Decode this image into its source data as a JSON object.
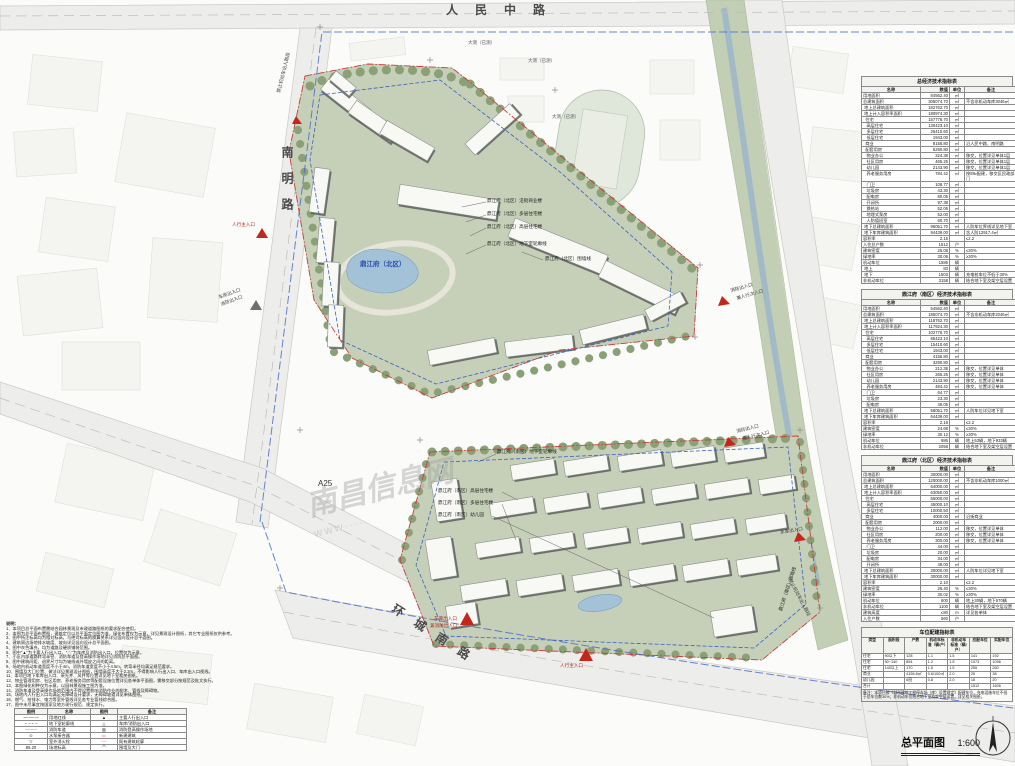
{
  "title_block": {
    "title": "总平面图",
    "scale": "1:600"
  },
  "roads": {
    "top": "人民中路",
    "left": "南明路",
    "bottom": "环城南路",
    "a25": "A25"
  },
  "survey_labels": {
    "s1": "大测（已测）",
    "s2": "大测（已测）",
    "s3": "大测（已测）"
  },
  "watermark": {
    "name": "南昌信息网",
    "www": "WWW····"
  },
  "project": {
    "north_center": "鼎江府（北区）"
  },
  "callouts": {
    "north": {
      "c1": "鼎江府（北区）沿街商业楼",
      "c2": "鼎江府（北区）多层住宅楼",
      "c3": "鼎江府（北区）高层住宅楼",
      "c4": "鼎江府（北区）地下室轮廓线",
      "c5": "鼎江府（北区）围墙线"
    },
    "south": {
      "s1": "鼎江府（南区）地下室轮廓线",
      "s2": "鼎江府（南区）高层住宅楼",
      "s3": "鼎江府（南区）多层住宅楼",
      "s4": "鼎江府（南区）幼儿园",
      "s5": "鼎江府（南区）围墙线"
    }
  },
  "entrances": {
    "left_main": "人行主入口",
    "left_garage": "车库出入口",
    "left_fire": "消防出入口",
    "right_fire_1": "消防出入口",
    "right_sub_1": "兼人行次入口",
    "right_fire_2": "消防出入口",
    "right_sub_2": "兼人行次入口",
    "right_garage": "车库出入口",
    "no_vehicle": "禁止机动车出入路段",
    "top_no_vehicle": "禁止机动车出入路段",
    "bottom_garage_1": "车库出入口",
    "bottom_garage_2": "兼消防出入口",
    "bottom_main": "人行主入口"
  },
  "notes": {
    "heading": "说明：",
    "items": [
      "1、本项目总平面布置需结合园林景观及市政道路图纸的要求配合使用。",
      "2、本图为总平面布置图，建筑定位以总平面定位图为准，绿化布置仅为示意，详见景观设计图纸，其它专业图纸仅供参考。",
      "3、图中所注标高均为相对标高，与绝对标高的换算关系详见竖向设计总平面图。",
      "4、建筑周边场地排水坡度、坡向详见竖向设计总平面图。",
      "5、图中灰色填充，均为道路及硬质铺装范围。",
      "6、图中\"▲\"为主要人行出入口，\"△\"为车库及消防出入口，位置仅为示意。",
      "7、小区内部道路转弯半径、消防车道及登高操作场地详见消防总平面图。",
      "8、图中建筑间距、退界尺寸均为轴线或外墙皮之间的距离。",
      "9、场地内机动车道宽度不小于4m，消防车道宽度不小于4.5m，转弯半径均满足规范要求。",
      "10、围墙及大门位置、做法详见景观设计图纸，围墙高度不大于2.2m，不得影响人行出入口、车库出入口视线。",
      "11、本项目地下车库出入口、采光井、风井等位置详见地下室相关图纸。",
      "12、物业管理用房、社区用房、养老服务用房等配套设施位置详见各单体平面图，需移交部分按规范及批文执行。",
      "13、本图绿化树种仅为示意，以园林景观施工图为准。",
      "14、消防车道及登高操作场地范围内不得设置影响消防作业的树木、管线及障碍物。",
      "15、场地内人行出入口均满足无障碍设计要求，无障碍坡道详见单体图纸。",
      "16、燃气、给排水、电力等室外管线详见各专业管线综合图。",
      "17、图中未尽事宜按国家及地方现行规范、规定执行。"
    ]
  },
  "legend": {
    "rows": [
      [
        "图例",
        "名称",
        "图例",
        "备注"
      ],
      [
        "—·—·—",
        "用地红线",
        "▲",
        "主要人行出入口"
      ],
      [
        "– – – –",
        "地下室轮廓线",
        "△",
        "车库/消防出入口"
      ],
      [
        "────",
        "消防车道",
        "▨",
        "消防登高操作场地"
      ],
      [
        "⊙",
        "水泵接合器",
        "▭",
        "新建建筑"
      ],
      [
        "▽",
        "室外消火栓",
        "┄┄",
        "既有建筑轮廓"
      ],
      [
        "85.20",
        "场地标高",
        "⌒",
        "围墙及大门"
      ]
    ]
  },
  "tables": {
    "overall": {
      "title": "总经济技术指标表",
      "rows": [
        [
          "名称",
          "数值",
          "单位",
          "备注"
        ],
        [
          "用地面积",
          "84562.40",
          "㎡",
          ""
        ],
        [
          "总建筑面积",
          "305074.70",
          "㎡",
          "不含非机动车库3046㎡"
        ],
        [
          " 地上总建筑面积",
          "182762.70",
          "㎡",
          ""
        ],
        [
          " 地上计入容积率面积",
          "180974.30",
          "㎡",
          ""
        ],
        [
          "  住宅",
          "157776.70",
          "㎡",
          ""
        ],
        [
          "   高层住宅",
          "130423.10",
          "㎡",
          ""
        ],
        [
          "   多层住宅",
          "25410.60",
          "㎡",
          ""
        ],
        [
          "   低层住宅",
          "1943.00",
          "㎡",
          ""
        ],
        [
          "  商业",
          "8156.80",
          "㎡",
          "沿人民中路、南明路"
        ],
        [
          "  配套用房",
          "5290.80",
          "㎡",
          ""
        ],
        [
          "   物业办公",
          "324.38",
          "㎡",
          "移交，位置详见单体1层"
        ],
        [
          "   社区用房",
          "465.25",
          "㎡",
          "移交，位置详见单体1层"
        ],
        [
          "   幼儿园",
          "2143.90",
          "㎡",
          "移交，位置详见单体1层"
        ],
        [
          "   养老服务用房",
          "784.42",
          "㎡",
          "按5‰配建，移交区民政部门"
        ],
        [
          "   门卫",
          "108.77",
          "㎡",
          ""
        ],
        [
          "   垃圾房",
          "43.30",
          "㎡",
          ""
        ],
        [
          "   配电房",
          "80.05",
          "㎡",
          ""
        ],
        [
          "   开闭所",
          "97.38",
          "㎡",
          ""
        ],
        [
          "   换热站",
          "52.06",
          "㎡",
          ""
        ],
        [
          "   地埋式泵房",
          "52.00",
          "㎡",
          ""
        ],
        [
          "   人防值班室",
          "60.70",
          "㎡",
          ""
        ],
        [
          " 地下总建筑面积",
          "96051.70",
          "㎡",
          "人防车位界线详见地下室"
        ],
        [
          " 地下车库建筑面积",
          "94439.00",
          "㎡",
          "含人防12917.4㎡"
        ],
        [
          "容积率",
          "2.15",
          "",
          "≤2.2"
        ],
        [
          "入住总户数",
          "1512",
          "户",
          ""
        ],
        [
          "建筑密度",
          "25.08",
          "%",
          "≤30%"
        ],
        [
          "绿地率",
          "30.06",
          "%",
          "≥30%"
        ],
        [
          "机动车位",
          "1586",
          "辆",
          ""
        ],
        [
          " 地上",
          "83",
          "辆",
          ""
        ],
        [
          " 地下",
          "1503",
          "辆",
          "充电桩车位不低于30%"
        ],
        [
          "非机动车位",
          "3158",
          "辆",
          "结合地下室及架空层设置"
        ]
      ]
    },
    "south": {
      "title": "鼎江府（南区）经济技术指标表",
      "rows": [
        [
          "名称",
          "数值",
          "单位",
          "备注"
        ],
        [
          "用地面积",
          "54562.40",
          "㎡",
          ""
        ],
        [
          "总建筑面积",
          "185074.70",
          "㎡",
          "不含非机动车库2046㎡"
        ],
        [
          " 地上总建筑面积",
          "118762.70",
          "㎡",
          ""
        ],
        [
          " 地上计入容积率面积",
          "117924.30",
          "㎡",
          ""
        ],
        [
          "  住宅",
          "102776.70",
          "㎡",
          ""
        ],
        [
          "   高层住宅",
          "85423.10",
          "㎡",
          ""
        ],
        [
          "   多层住宅",
          "15410.60",
          "㎡",
          ""
        ],
        [
          "   低层住宅",
          "1943.00",
          "㎡",
          ""
        ],
        [
          "  商业",
          "4156.80",
          "㎡",
          ""
        ],
        [
          "  配套用房",
          "3290.80",
          "㎡",
          ""
        ],
        [
          "   物业办公",
          "212.38",
          "㎡",
          "移交，位置详见单体"
        ],
        [
          "   社区用房",
          "265.25",
          "㎡",
          "移交，位置详见单体"
        ],
        [
          "   幼儿园",
          "2143.90",
          "㎡",
          "移交，位置详见单体"
        ],
        [
          "   养老服务用房",
          "484.42",
          "㎡",
          "移交，位置详见单体"
        ],
        [
          "   门卫",
          "64.77",
          "㎡",
          ""
        ],
        [
          "   垃圾房",
          "23.30",
          "㎡",
          ""
        ],
        [
          "   配电房",
          "46.05",
          "㎡",
          ""
        ],
        [
          " 地下总建筑面积",
          "66051.70",
          "㎡",
          "人防车位详见地下室"
        ],
        [
          " 地下车库建筑面积",
          "64439.00",
          "㎡",
          ""
        ],
        [
          "容积率",
          "2.16",
          "",
          "≤2.2"
        ],
        [
          "建筑密度",
          "24.68",
          "%",
          "≤30%"
        ],
        [
          "绿地率",
          "30.12",
          "%",
          "≥30%"
        ],
        [
          "机动车位",
          "986",
          "辆",
          "地上53辆，地下933辆"
        ],
        [
          "非机动车位",
          "2058",
          "辆",
          "结合地下室及架空层设置"
        ]
      ]
    },
    "north": {
      "title": "鼎江府（北区）经济技术指标表",
      "rows": [
        [
          "名称",
          "数值",
          "单位",
          "备注"
        ],
        [
          "用地面积",
          "30000.00",
          "㎡",
          ""
        ],
        [
          "总建筑面积",
          "120000.00",
          "㎡",
          "不含非机动车库1000㎡"
        ],
        [
          " 地上总建筑面积",
          "64000.00",
          "㎡",
          ""
        ],
        [
          " 地上计入容积率面积",
          "63050.00",
          "㎡",
          ""
        ],
        [
          "  住宅",
          "55000.00",
          "㎡",
          ""
        ],
        [
          "   高层住宅",
          "45000.10",
          "㎡",
          ""
        ],
        [
          "   多层住宅",
          "10000.50",
          "㎡",
          ""
        ],
        [
          "  商业",
          "4000.00",
          "㎡",
          "沿街商业"
        ],
        [
          "  配套用房",
          "2000.00",
          "㎡",
          ""
        ],
        [
          "   物业办公",
          "112.00",
          "㎡",
          "移交，位置详见单体"
        ],
        [
          "   社区用房",
          "200.00",
          "㎡",
          "移交，位置详见单体"
        ],
        [
          "   养老服务用房",
          "300.00",
          "㎡",
          "移交，位置详见单体"
        ],
        [
          "   门卫",
          "44.00",
          "㎡",
          ""
        ],
        [
          "   垃圾房",
          "20.00",
          "㎡",
          ""
        ],
        [
          "   配电房",
          "34.00",
          "㎡",
          ""
        ],
        [
          "   开闭所",
          "48.00",
          "㎡",
          ""
        ],
        [
          " 地下总建筑面积",
          "30000.00",
          "㎡",
          "人防车位详见地下室"
        ],
        [
          " 地下车库建筑面积",
          "30000.00",
          "㎡",
          ""
        ],
        [
          "容积率",
          "2.10",
          "",
          "≤2.2"
        ],
        [
          "建筑密度",
          "26.40",
          "%",
          "≤30%"
        ],
        [
          "绿地率",
          "30.02",
          "%",
          "≥30%"
        ],
        [
          "机动车位",
          "600",
          "辆",
          "地上30辆，地下570辆"
        ],
        [
          "非机动车位",
          "1100",
          "辆",
          "结合地下室及架空层设置"
        ],
        [
          "建筑高度",
          "≤80",
          "m",
          "详见各单体"
        ],
        [
          "入住户数",
          "560",
          "户",
          ""
        ]
      ]
    },
    "parking": {
      "title": "车位配建指标表",
      "rows": [
        [
          "类型",
          "面积段",
          "户数",
          "机动车标准（辆/户）",
          "非机动车标准（辆/户）",
          "应配车位",
          "实配车位"
        ],
        [
          "住宅",
          "90以下",
          "128",
          "1.1",
          "1.5",
          "141",
          "192"
        ],
        [
          "住宅",
          "90~140",
          "894",
          "1.2",
          "1.5",
          "1073",
          "1096"
        ],
        [
          "住宅",
          "140以上",
          "170",
          "1.5",
          "1.5",
          "255",
          "260"
        ],
        [
          "商业",
          "",
          "4156.8㎡",
          "0.6/100㎡",
          "2.0",
          "25",
          "38"
        ],
        [
          "幼儿园",
          "",
          "6班",
          "0.8",
          "2.0",
          "18",
          "20"
        ],
        [
          "合计",
          "",
          "",
          "",
          "",
          "1512",
          "1606"
        ]
      ],
      "note": "备注：本项目按《城市建筑工程停车场（库）设置规定》配建车位，充电设施车位不低于总车位数30%；非机动车位结合地下室及架空层设置，详见相关图纸。"
    }
  }
}
